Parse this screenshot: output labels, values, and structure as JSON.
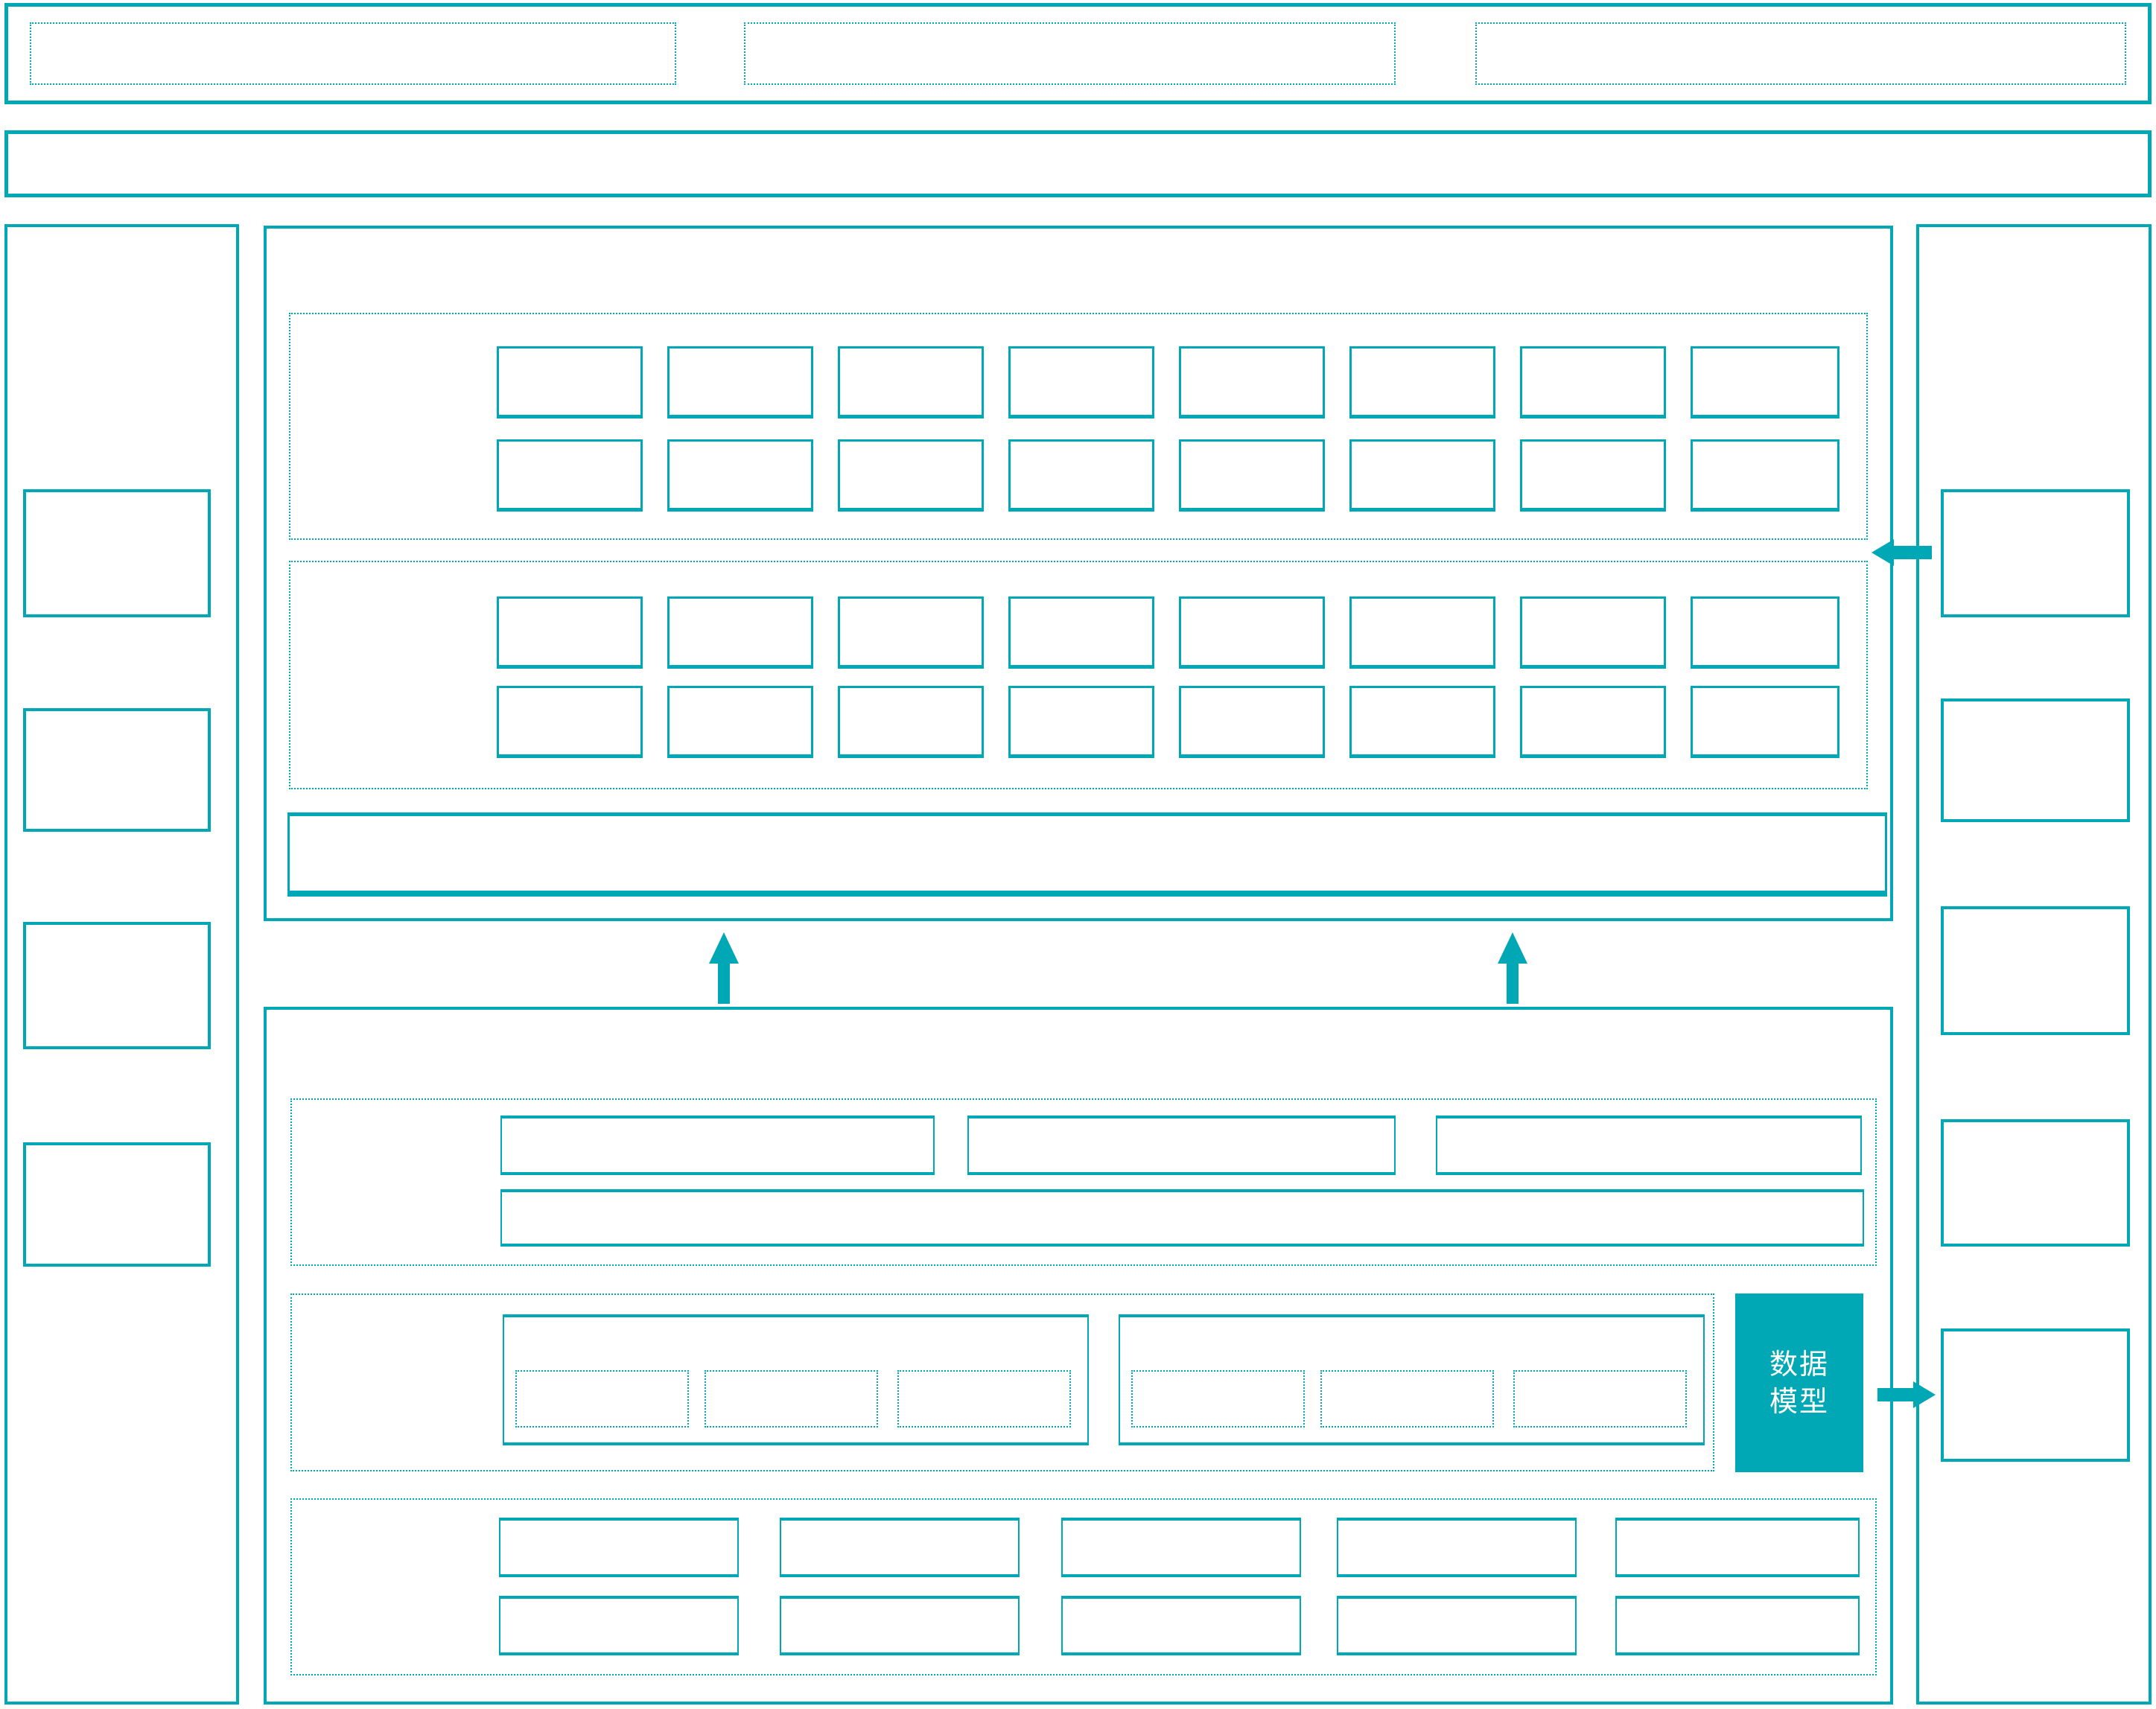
{
  "colors": {
    "accent": "#00A8B6",
    "background": "#FFFFFF",
    "text_on_accent": "#FFFFFF"
  },
  "icons": {
    "arrow_up": "▲",
    "arrow_left": "◀",
    "arrow_right": "▶"
  },
  "main_bottom": {
    "data_model_box": {
      "label": "数据模型",
      "line1": "数据",
      "line2": "模型"
    }
  }
}
